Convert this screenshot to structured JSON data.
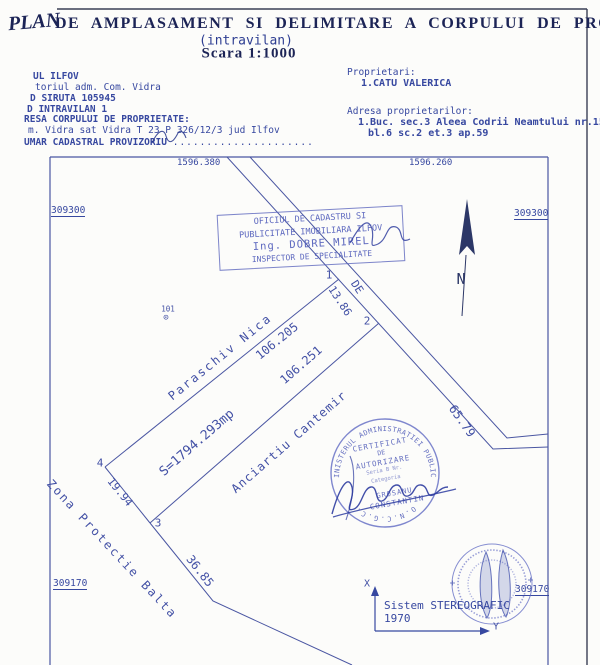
{
  "colors": {
    "ink": "#3c4aa0",
    "stamp": "#5c67be",
    "title": "#1c2456"
  },
  "title": {
    "handwritten": "PLAN",
    "main": "DE AMPLASAMENT SI DELIMITARE A CORPULUI DE PROPRIETATE",
    "sub": "(intravilan)",
    "scale": "Scara 1:1000"
  },
  "header_left": {
    "line1": "UL ILFOV",
    "line2": "toriul adm. Com. Vidra",
    "line3": "D SIRUTA 105945",
    "line4": "D INTRAVILAN 1",
    "line5": "RESA CORPULUI DE PROPRIETATE:",
    "line6": "m. Vidra sat Vidra T 23 P 326/12/3 jud Ilfov",
    "line7": "UMAR CADASTRAL PROVIZORIU",
    "line7_dots": "....................."
  },
  "header_right": {
    "owners_label": "Proprietari:",
    "owner1": "1.CATU VALERICA",
    "address_label": "Adresa proprietarilor:",
    "address1": "1.Buc. sec.3 Aleea Codrii Neamtului nr.15",
    "address2": "bl.6 sc.2 et.3 ap.59"
  },
  "map": {
    "grid": {
      "top_left": "1596.380",
      "top_right": "1596.260",
      "left_upper": "309300",
      "right_upper": "309300",
      "left_lower": "309170",
      "right_lower": "309170"
    },
    "points": {
      "p1": "1",
      "p2": "2",
      "p3": "3",
      "p4": "4"
    },
    "lengths": {
      "d_1_2": "13.86",
      "d_1_4": "106.205",
      "d_2_3": "106.251",
      "d_4_3": "19.94",
      "d_3_b": "36.85",
      "d_road": "65.79"
    },
    "area": "S=1794.293mp",
    "road_label": "DE",
    "point_code": "101",
    "point_code_symbol": "⊙",
    "neighbors": {
      "north": "Paraschiv Nica",
      "south": "Anciartiu Cantemir",
      "west": "Zona Protectie Balta"
    },
    "north_letter": "N"
  },
  "stamps": {
    "office": {
      "line1": "OFICIUL DE CADASTRU SI",
      "line2": "PUBLICITATE IMOBILIARA ILFOV",
      "line3": "Ing. DOBRE MIREL",
      "line4": "INSPECTOR DE SPECIALITATE"
    },
    "round1": {
      "arc_top": "MINISTERUL ADMINISTRATIEI PUBLICE",
      "arc_bottom": "O.N.C.G.C.",
      "line1": "CERTIFICAT",
      "line2": "DE",
      "line3": "AUTORIZARE",
      "line4": "Seria B Nr.",
      "line5": "Categoria",
      "name1": "GROSANU",
      "name2": "CONSTANTIN"
    }
  },
  "coord_system": {
    "x_label": "X",
    "y_label": "Y",
    "line1": "Sistem STEREOGRAFIC",
    "line2": "1970"
  }
}
